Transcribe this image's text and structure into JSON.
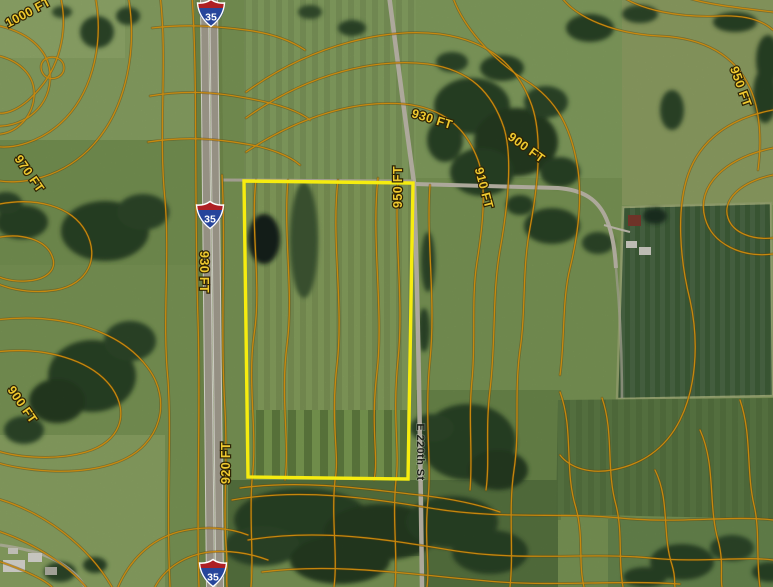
{
  "map": {
    "colors": {
      "parcel_boundary": "#f6ec0f",
      "contour_line": "#cd8b0d",
      "contour_label": "#efc92f",
      "shield_red": "#ae1f24",
      "shield_blue": "#27459b"
    },
    "contour_labels": [
      {
        "text": "1000 FT"
      },
      {
        "text": "970 FT"
      },
      {
        "text": "930 FT"
      },
      {
        "text": "920 FT"
      },
      {
        "text": "900 FT"
      },
      {
        "text": "930 FT"
      },
      {
        "text": "900 FT"
      },
      {
        "text": "910 FT"
      },
      {
        "text": "950 FT"
      },
      {
        "text": "950 FT"
      }
    ],
    "road_labels": [
      {
        "text": "E 220th St"
      }
    ],
    "interstate_shields": [
      {
        "number": "35"
      },
      {
        "number": "35"
      },
      {
        "number": "35"
      }
    ]
  }
}
